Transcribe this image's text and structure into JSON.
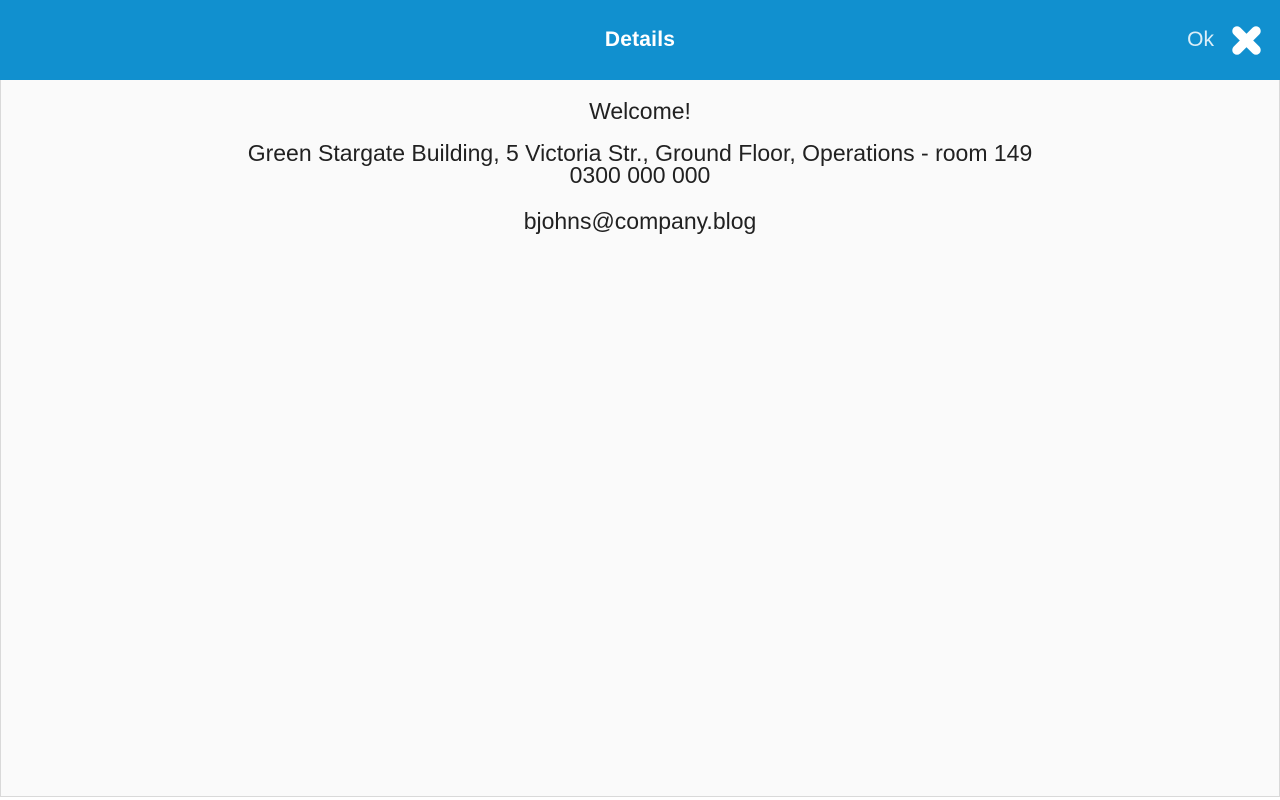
{
  "theme": {
    "header_bg": "#1190CF",
    "header_fg": "#FFFFFF",
    "content_bg": "#FAFAFA",
    "content_fg": "#212121"
  },
  "header": {
    "title": "Details",
    "ok_label": "Ok",
    "close_icon": "heavy-x-close-icon"
  },
  "content": {
    "welcome": "Welcome!",
    "address": "Green Stargate Building, 5 Victoria Str., Ground Floor, Operations - room 149",
    "phone": "0300 000 000",
    "email": "bjohns@company.blog"
  }
}
